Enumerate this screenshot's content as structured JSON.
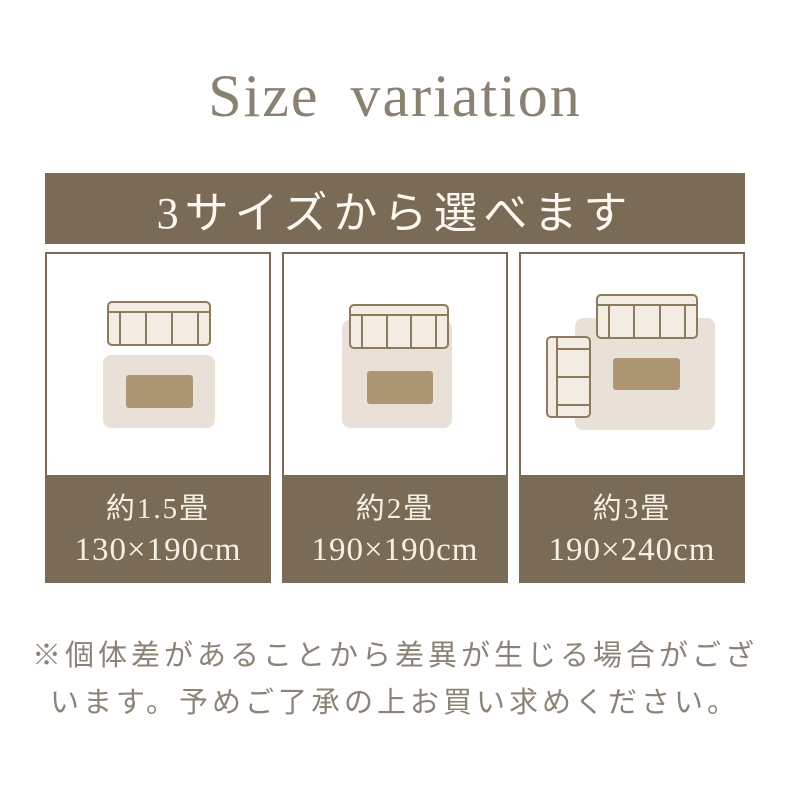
{
  "title": "Size variation",
  "banner": {
    "text": "3サイズから選べます"
  },
  "cards": [
    {
      "illustration": "rug-below-3seat-sofa-with-table",
      "size_label": "約1.5畳",
      "dimensions": "130×190cm"
    },
    {
      "illustration": "square-rug-under-3seat-sofa-with-table",
      "size_label": "約2畳",
      "dimensions": "190×190cm"
    },
    {
      "illustration": "large-rug-under-3seat-and-2seat-sofas-with-table",
      "size_label": "約3畳",
      "dimensions": "190×240cm"
    }
  ],
  "disclaimer": {
    "line1": "※個体差があることから差異が生じる場合がござ",
    "line2": "います。予めご了承の上お買い求めください。"
  },
  "colors": {
    "brown": "#7a6b57",
    "banner_text": "#fcf8f0",
    "label_text": "#f6f0e4",
    "title_text": "#8b8172",
    "disclaimer_text": "#8c8376",
    "rug": "#e9e1d7",
    "table": "#ac9674",
    "sofa_fill": "#f3ece2",
    "sofa_stroke": "#8d7b5e"
  }
}
